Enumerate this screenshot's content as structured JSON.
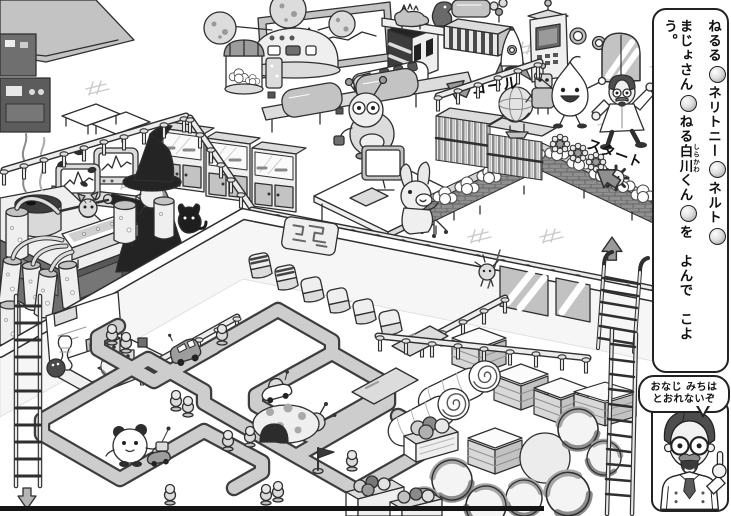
{
  "banner": {
    "characters": [
      {
        "label": "ねるる",
        "icon": "neruru-icon"
      },
      {
        "label": "ネリトニー",
        "icon": "neritonii-icon"
      },
      {
        "label": "ネルト",
        "icon": "neruto-icon"
      },
      {
        "label": "まじょさん",
        "icon": "majosan-icon"
      },
      {
        "label_prefix": "ねる",
        "kanji": "白川",
        "furigana": "しらかわ",
        "suffix": "くん",
        "icon": "shirakawa-icon"
      }
    ],
    "instruction": "を　よんで　こよう。"
  },
  "speech_bubble": {
    "line1": "おなじ みちは",
    "line2": "とおれないぞ"
  },
  "scene": {
    "labels": {
      "goal": "ゴール",
      "start": "スタート"
    }
  },
  "colors": {
    "ink": "#222222",
    "outline": "#2f2f2f",
    "road_fill": "#cdcdcd",
    "wall_gray": "#c2c2c2",
    "page_bg": "#ffffff"
  }
}
